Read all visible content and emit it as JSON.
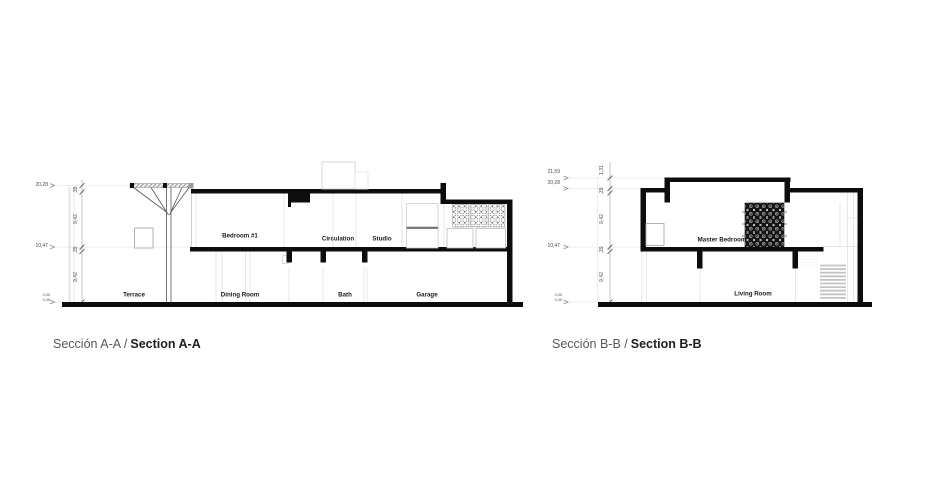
{
  "page": {
    "background": "#ffffff"
  },
  "colors": {
    "ink": "#111111",
    "line_light": "#dddddd",
    "line_mid": "#999999",
    "label_text": "#1a1a1a",
    "dim_text": "#4a4a4a",
    "caption_gray": "#57585b",
    "caption_dark": "#1d1e20"
  },
  "sectionA": {
    "caption": {
      "es": "Sección A-A /",
      "en": "Section A-A"
    },
    "rooms": {
      "terrace": "Terrace",
      "bedroom1": "Bedroom #1",
      "dining": "Dining Room",
      "circulation": "Circulation",
      "studio": "Studio",
      "bath": "Bath",
      "garage": "Garage"
    },
    "levels": {
      "top": "20,28",
      "upper": "10,47",
      "ground_a": "0,00",
      "ground_b": "0,00"
    },
    "dims": {
      "d1": ",39",
      "d2": "9,42",
      "d3": ",39",
      "d4": "9,42"
    }
  },
  "sectionB": {
    "caption": {
      "es": "Sección B-B /",
      "en": "Section B-B"
    },
    "rooms": {
      "master": "Master Bedroom",
      "living": "Living Room"
    },
    "levels": {
      "parapet": "21,59",
      "top": "20,28",
      "upper": "10,47",
      "ground_a": "0,00",
      "ground_b": "0,00"
    },
    "dims": {
      "d0": "1,31",
      "d1": ",39",
      "d2": "9,42",
      "d3": ",39",
      "d4": "9,42"
    }
  }
}
